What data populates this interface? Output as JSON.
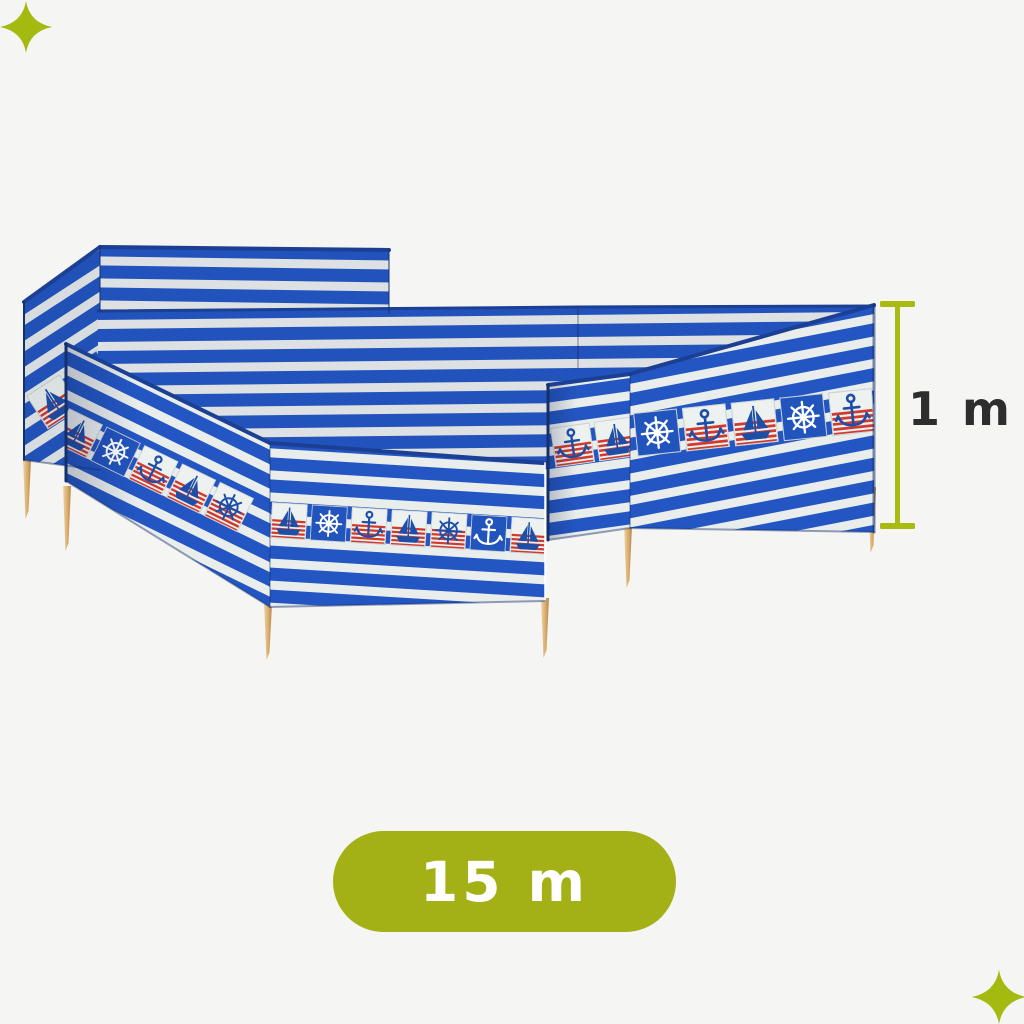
{
  "page": {
    "background_color": "#f5f5f4",
    "type": "product-photo-with-dimension-annotations"
  },
  "product": {
    "name": "beach-windbreak-blue-white-striped-nautical",
    "colors": {
      "stripe_blue": "#2356c2",
      "stripe_white": "#e9edec",
      "motif_red": "#d23a2e",
      "motif_navy": "#1d4fa8",
      "tile_white": "#edf1ef",
      "tile_blue": "#2254bd",
      "hem_navy": "#1b4093",
      "pole_wood": "#ddb273",
      "accent_green": "#a5b614",
      "label_dark": "#2d2d2d",
      "badge_green": "#a3b117",
      "measure_green": "#a9bb10"
    },
    "icons": [
      "sailboat-icon",
      "ship-wheel-icon",
      "anchor-icon",
      "sparkle-icon"
    ],
    "bands": {
      "left_return": {
        "tile": 40,
        "gap": 4,
        "tiles": [
          "sail-w",
          "wheel-b"
        ]
      },
      "front_left_a": {
        "tile": 38,
        "gap": 4,
        "tiles": [
          "sail-w",
          "wheel-b",
          "anchor-w",
          "sail-w",
          "wheel-w"
        ]
      },
      "front_left_b": {
        "tile": 36,
        "gap": 4,
        "tiles": [
          "sail-w",
          "wheel-b",
          "anchor-w",
          "sail-w",
          "wheel-w",
          "anchor-b",
          "sail-w"
        ]
      },
      "near_right_a": {
        "tile": 40,
        "gap": 4,
        "tiles": [
          "anchor-w",
          "sail-w"
        ]
      },
      "near_right_b": {
        "tile": 44,
        "gap": 5,
        "tiles": [
          "wheel-b",
          "anchor-w",
          "sail-w",
          "wheel-b",
          "anchor-w",
          "sail-b"
        ]
      }
    }
  },
  "annotations": {
    "height_label": "1 m",
    "length_label": "15 m"
  }
}
